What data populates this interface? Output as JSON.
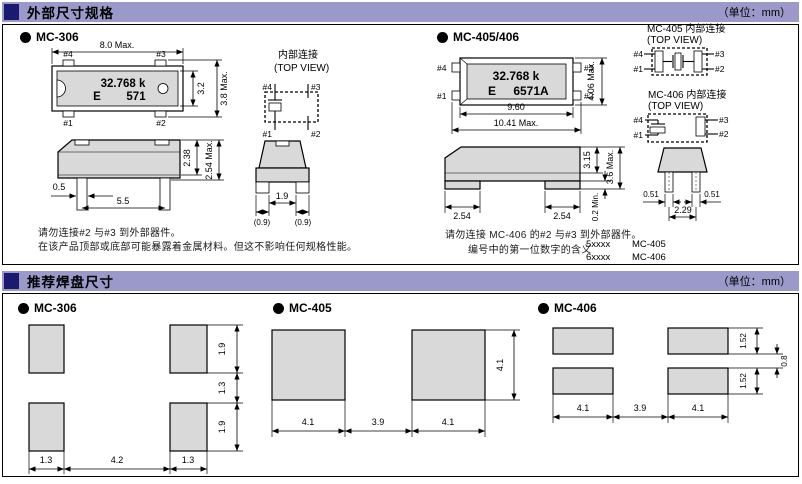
{
  "page": {
    "unit": "（单位：mm）"
  },
  "colors": {
    "header_bar": "#9a99c9",
    "marker_square": "#1a1a70",
    "body_gray": "#d9d9d9"
  },
  "pins": {
    "p1": "#1",
    "p2": "#2",
    "p3": "#3",
    "p4": "#4"
  },
  "sec1": {
    "title": "外部尺寸规格",
    "mc306": {
      "label": "MC-306",
      "top": {
        "dim_w": "8.0  Max.",
        "mark1": "32.768 k",
        "mark2a": "E",
        "mark2b": "571",
        "dim_h_inner": "3.2",
        "dim_h_outer": "3.8 Max."
      },
      "internal": {
        "t1": "内部连接",
        "t2": "(TOP VIEW)"
      },
      "side": {
        "dim_body": "2.38",
        "dim_total": "2.54 Max.",
        "dim_lead_w": "0.5",
        "dim_span": "5.5"
      },
      "end": {
        "dim_gap": "1.9",
        "dim_l": "(0.9)",
        "dim_r": "(0.9)"
      },
      "note1": "请勿连接#2 与#3 到外部器件。",
      "note2": "在该产品顶部或底部可能暴露着金属材料。但这不影响任何规格性能。"
    },
    "mc405": {
      "label": "MC-405/406",
      "top": {
        "dim_w_inner": "9.60",
        "dim_w_outer": "10.41 Max.",
        "dim_h": "4.06 Max.",
        "mark1": "32.768 k",
        "mark2a": "E",
        "mark2b": "6571A"
      },
      "int405": {
        "t1": "MC-405 内部连接",
        "t2": "(TOP VIEW)"
      },
      "int406": {
        "t1": "MC-406 内部连接",
        "t2": "(TOP VIEW)"
      },
      "side": {
        "dim_body": "3.15",
        "dim_total": "3.6 Max.",
        "dim_standoff": "0.2 Min.",
        "dim_pad_l": "2.54",
        "dim_pad_r": "2.54"
      },
      "end": {
        "dim_l": "0.51",
        "dim_r": "0.51",
        "dim_c": "2.29"
      },
      "note1": "请勿连接 MC-406 的#2 与#3 到外部器件。",
      "note2": "编号中的第一位数字的含义",
      "codes": [
        {
          "code": "5xxxx",
          "name": "MC-405"
        },
        {
          "code": "6xxxx",
          "name": "MC-406"
        }
      ]
    }
  },
  "sec2": {
    "title": "推荐焊盘尺寸",
    "mc306": {
      "label": "MC-306",
      "h": [
        "1.3",
        "4.2",
        "1.3"
      ],
      "v": [
        "1.9",
        "1.3",
        "1.9"
      ]
    },
    "mc405": {
      "label": "MC-405",
      "h": [
        "4.1",
        "3.9",
        "4.1"
      ],
      "v": [
        "4.1"
      ]
    },
    "mc406": {
      "label": "MC-406",
      "h": [
        "4.1",
        "3.9",
        "4.1"
      ],
      "v": [
        "1.52",
        "0.8",
        "1.52"
      ]
    }
  }
}
